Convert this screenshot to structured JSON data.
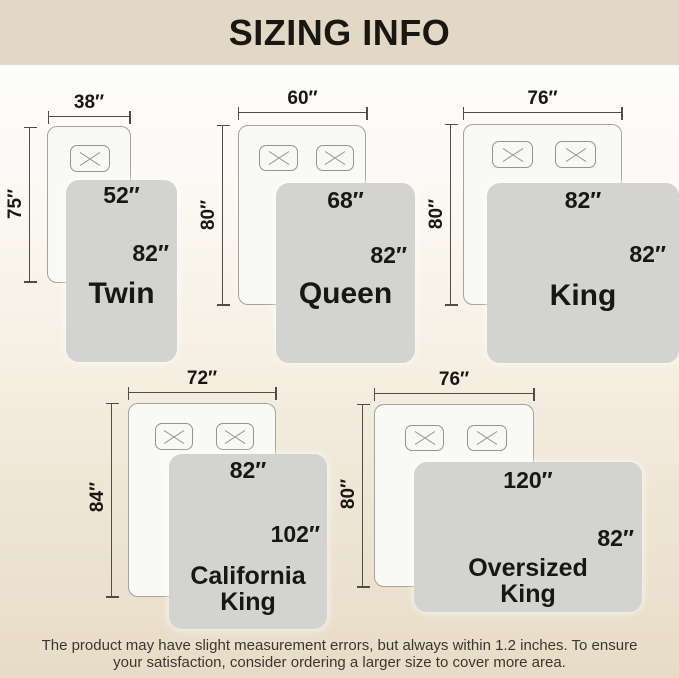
{
  "title": "SIZING INFO",
  "sizes": [
    {
      "name": "Twin",
      "mattress_width": "38″",
      "mattress_length": "75″",
      "blanket_width": "52″",
      "blanket_length": "82″",
      "pillows": 1
    },
    {
      "name": "Queen",
      "mattress_width": "60″",
      "mattress_length": "80″",
      "blanket_width": "68″",
      "blanket_length": "82″",
      "pillows": 2
    },
    {
      "name": "King",
      "mattress_width": "76″",
      "mattress_length": "80″",
      "blanket_width": "82″",
      "blanket_length": "82″",
      "pillows": 2
    },
    {
      "name": "California King",
      "mattress_width": "72″",
      "mattress_length": "84″",
      "blanket_width": "82″",
      "blanket_length": "102″",
      "pillows": 2
    },
    {
      "name": "Oversized King",
      "mattress_width": "76″",
      "mattress_length": "80″",
      "blanket_width": "120″",
      "blanket_length": "82″",
      "pillows": 2
    }
  ],
  "disclaimer": "The product may have slight measurement errors, but always within 1.2 inches. To ensure your satisfaction, consider ordering a larger size to cover more area.",
  "colors": {
    "band": "#e3d8c6",
    "background_bottom": "#e8dcc7",
    "blanket": "#d3d3d1",
    "mattress": "#f9f9f6",
    "dim_line": "#504d47",
    "label_text": "#191712",
    "disclaimer_text": "#3c372d"
  }
}
